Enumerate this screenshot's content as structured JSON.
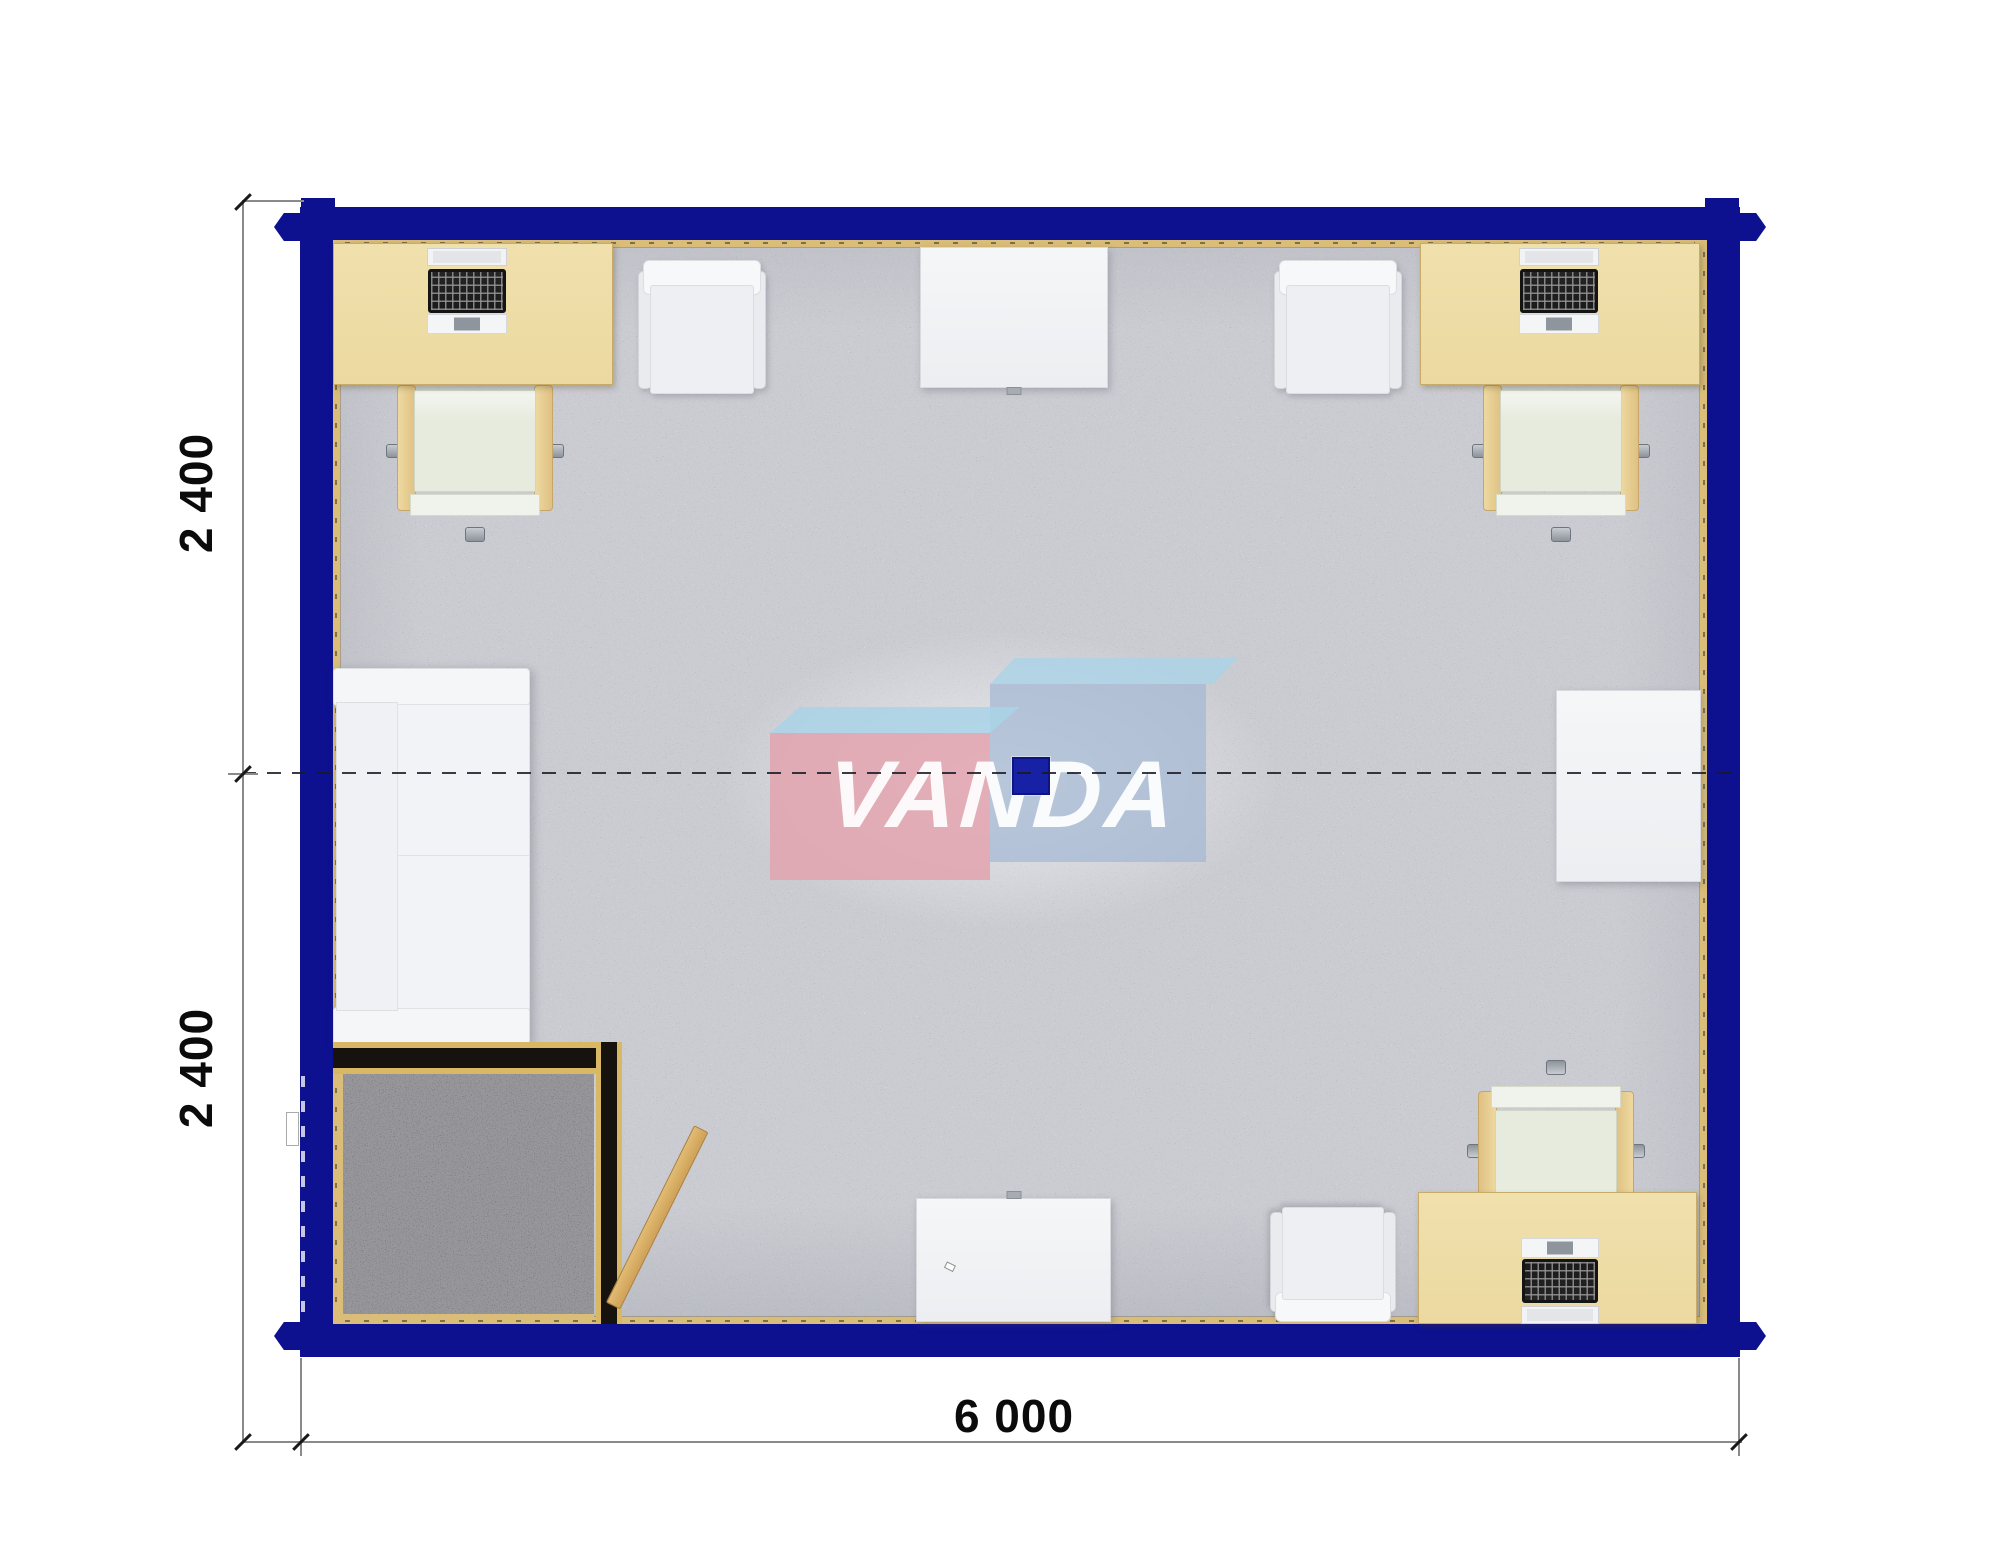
{
  "dimensions": {
    "left_top": "2 400",
    "left_bottom": "2 400",
    "bottom": "6 000"
  },
  "watermark": {
    "word": "VANDA"
  },
  "colors": {
    "navy": "#0d1190",
    "desk": "#ecd9a1",
    "trim": "#d9bd78",
    "carpet": "#cbccd2",
    "carpet_dark": "#97979b",
    "cushion": "#e6ebdd",
    "ply": "#d8b765",
    "lamp": "#1721a5",
    "lpink": "#e2a3ae",
    "lblue": "#a9d3e8",
    "lgray": "#a3b9d2",
    "dimline": "#8a8a8a",
    "dimtext": "#0b0b0b",
    "door": "#d9ae67"
  },
  "plan": {
    "items": [
      {
        "type": "ochair",
        "name": "office-chair-top-left",
        "x": 64,
        "y": 142,
        "w": 156,
        "h": 150
      },
      {
        "type": "ochair",
        "name": "office-chair-top-right",
        "x": 1150,
        "y": 142,
        "w": 156,
        "h": 150
      },
      {
        "type": "ochair",
        "name": "office-chair-bottom-right",
        "x": 1145,
        "y": 830,
        "w": 156,
        "h": 150,
        "rot": 180
      },
      {
        "type": "cchair",
        "name": "visitor-chair-top-left",
        "x": 305,
        "y": 20,
        "w": 128,
        "h": 140
      },
      {
        "type": "cchair",
        "name": "visitor-chair-top-right",
        "x": 941,
        "y": 20,
        "w": 128,
        "h": 140
      },
      {
        "type": "cchair",
        "name": "visitor-chair-bottom",
        "x": 937,
        "y": 962,
        "w": 126,
        "h": 120,
        "rot": 180
      },
      {
        "type": "sofa",
        "name": "sofa",
        "x": 0,
        "y": 428,
        "w": 197,
        "h": 377
      },
      {
        "type": "desk",
        "name": "desk-top-left",
        "x": 0,
        "y": 3,
        "w": 280,
        "h": 142
      },
      {
        "type": "desk",
        "name": "desk-top-right",
        "x": 1087,
        "y": 3,
        "w": 280,
        "h": 142
      },
      {
        "type": "desk",
        "name": "desk-bottom-right",
        "x": 1085,
        "y": 952,
        "w": 279,
        "h": 132
      },
      {
        "type": "laptop",
        "name": "laptop-top-left",
        "x": 91,
        "y": 8,
        "w": 86,
        "h": 86
      },
      {
        "type": "laptop",
        "name": "laptop-top-right",
        "x": 1183,
        "y": 8,
        "w": 86,
        "h": 86
      },
      {
        "type": "laptop",
        "name": "laptop-bottom-right",
        "x": 1185,
        "y": 998,
        "w": 84,
        "h": 86,
        "rot": 180
      },
      {
        "type": "table",
        "name": "table-top",
        "x": 587,
        "y": 7,
        "w": 188,
        "h": 141,
        "tab": "bottom"
      },
      {
        "type": "table",
        "name": "table-bottom",
        "x": 583,
        "y": 958,
        "w": 195,
        "h": 124,
        "tab": "top"
      },
      {
        "type": "table",
        "name": "table-right",
        "x": 1223,
        "y": 450,
        "w": 145,
        "h": 192
      },
      {
        "type": "partH",
        "name": "entry-partition-horizontal",
        "x": 0,
        "y": 802,
        "w": 289,
        "h": 32
      },
      {
        "type": "partV",
        "name": "entry-partition-vertical",
        "x": 263,
        "y": 802,
        "w": 26,
        "h": 282
      },
      {
        "type": "entry",
        "name": "entry-floor",
        "x": 5,
        "y": 834,
        "w": 256,
        "h": 246
      },
      {
        "type": "door",
        "name": "entry-door",
        "x": 272,
        "y": 868,
        "w": 16,
        "h": 198,
        "rot": 26.5
      },
      {
        "type": "halo",
        "name": "watermark-halo",
        "x": 387,
        "y": 390,
        "w": 560,
        "h": 300
      },
      {
        "type": "logoRightTop",
        "name": "logo-blue-box-top",
        "x": 657,
        "y": 418,
        "w": 248,
        "h": 26
      },
      {
        "type": "logoRight",
        "name": "logo-blue-box",
        "x": 657,
        "y": 444,
        "w": 216,
        "h": 178
      },
      {
        "type": "logoPinkTop",
        "name": "logo-pink-box-top",
        "x": 437,
        "y": 467,
        "w": 250,
        "h": 26
      },
      {
        "type": "logoPink",
        "name": "logo-pink-box",
        "x": 437,
        "y": 493,
        "w": 220,
        "h": 147
      },
      {
        "type": "word",
        "name": "watermark-text",
        "x": 430,
        "y": 460,
        "w": 480,
        "h": 190,
        "bind": "watermark.word"
      },
      {
        "type": "lamp",
        "name": "ceiling-lamp",
        "x": 679,
        "y": 517,
        "w": 38,
        "h": 38
      }
    ]
  }
}
